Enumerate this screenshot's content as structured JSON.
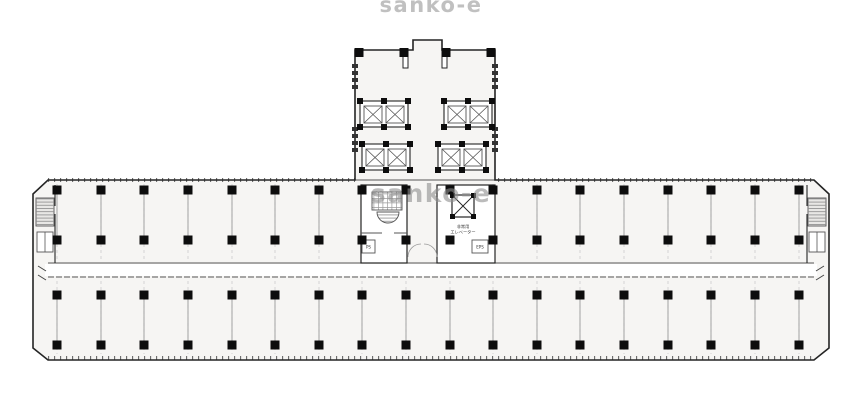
{
  "page": {
    "background": "#ffffff",
    "kind": "scanned building floor plan"
  },
  "watermarks": {
    "top": "sanko-e",
    "middle": "sanko-e"
  },
  "labels": {
    "ps": "PS",
    "eps": "EPS",
    "emergency_1": "非常用",
    "emergency_2": "エレベーター"
  },
  "colors": {
    "wall": "#242424",
    "wall_light": "#555555",
    "thin": "#9a9a9a",
    "faint": "#c6c6c6",
    "column": "#0d0d0d",
    "band_fill": "#f6f5f3",
    "corridor_fill": "#ffffff",
    "stair_fill": "#e8e7e5",
    "tooth": "#333333",
    "label": "#333333",
    "watermark": "#8e8e8e"
  },
  "plan": {
    "canvas": {
      "w": 862,
      "h": 400
    },
    "wing": {
      "x1": 33,
      "x2": 829,
      "top": 180,
      "bottom": 360,
      "chamfer": 15,
      "band1_bottom": 263,
      "corridor_bottom": 277,
      "glass_bottom": 358,
      "inner_left": 55,
      "inner_right": 807
    },
    "grid": {
      "xs": [
        57,
        101,
        144,
        188,
        232,
        275,
        319,
        362,
        406,
        450,
        493,
        537,
        580,
        624,
        668,
        711,
        755,
        799
      ],
      "rows": [
        190,
        240,
        295,
        345
      ],
      "size": 9
    },
    "tower": {
      "x1": 355,
      "x2": 495,
      "top": 50,
      "bump_x1": 413,
      "bump_x2": 442,
      "bump_top": 40,
      "stub_xs": [
        403,
        442
      ],
      "stub_h": 18,
      "teeth_ys": [
        64,
        71,
        78,
        85,
        127,
        134,
        141,
        148
      ],
      "top_cols": [
        359,
        404,
        446,
        491
      ],
      "banks": [
        [
          360,
          101
        ],
        [
          444,
          101
        ],
        [
          362,
          144
        ],
        [
          438,
          144
        ]
      ],
      "bank_w": 48,
      "bank_h": 26
    },
    "core": {
      "left": {
        "x": 361,
        "y": 185,
        "w": 46,
        "h": 78
      },
      "right": {
        "x": 437,
        "y": 185,
        "w": 58,
        "h": 78
      },
      "toilet": {
        "x": 372,
        "y": 192,
        "w": 30,
        "h": 18
      },
      "basin": {
        "x": 377,
        "y": 212,
        "w": 22,
        "h": 11
      },
      "xlift": {
        "x": 452,
        "y": 195,
        "w": 22,
        "h": 22
      },
      "ps_box": {
        "x": 362,
        "y": 240,
        "w": 13,
        "h": 13
      },
      "eps_box": {
        "x": 472,
        "y": 240,
        "w": 16,
        "h": 13
      }
    },
    "ends": {
      "left_x": 36,
      "right_x": 808,
      "stair_y": 198,
      "stair_w": 18,
      "stair_h": 28,
      "shaft_y": 232,
      "shaft_w": 16,
      "shaft_h": 20
    }
  }
}
